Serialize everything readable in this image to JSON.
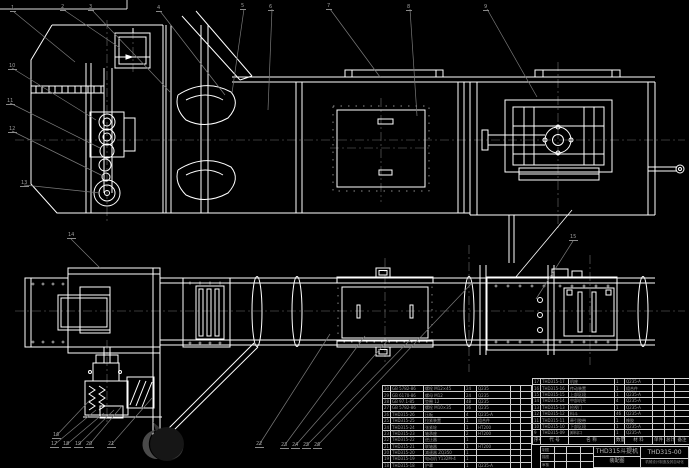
{
  "page": {
    "background": "#000000",
    "line_color": "#ffffff",
    "leader_color": "#7a7a7a",
    "text_color": "#9a9a9a"
  },
  "title_block": {
    "product_name": "THD315斗提机",
    "drawing_type": "装配图",
    "drawing_no": "THD315-00",
    "org": "机械设计制造及其自动化",
    "signoff_rows": [
      [
        "制图",
        "",
        "",
        ""
      ],
      [
        "描图",
        "",
        "",
        ""
      ],
      [
        "审核",
        "",
        "",
        ""
      ]
    ]
  },
  "bom_right": {
    "headers": [
      "序号",
      "代 号",
      "名 称",
      "数量",
      "材 料",
      "单件",
      "总计",
      "备注"
    ],
    "rows": [
      [
        "17",
        "THD315-17",
        "机座",
        "1",
        "Q235-A",
        "",
        "",
        ""
      ],
      [
        "16",
        "THD315-16",
        "传动装置",
        "1",
        "组合件",
        "",
        "",
        ""
      ],
      [
        "15",
        "THD315-15",
        "上部区段",
        "1",
        "Q235-A",
        "",
        "",
        ""
      ],
      [
        "14",
        "THD315-14",
        "中部机壳",
        "4",
        "Q235-A",
        "",
        "",
        ""
      ],
      [
        "13",
        "THD315-13",
        "检视门",
        "1",
        "Q235-A",
        "",
        "",
        ""
      ],
      [
        "12",
        "THD315-12",
        "料斗",
        "46",
        "Q235-A",
        "",
        "",
        ""
      ],
      [
        "11",
        "THD315-11",
        "牵引胶带",
        "1",
        "橡胶",
        "",
        "",
        ""
      ],
      [
        "10",
        "THD315-10",
        "下部区段",
        "1",
        "Q235-A",
        "",
        "",
        ""
      ],
      [
        "9",
        "THD315-09",
        "卸料口",
        "1",
        "Q235-A",
        "",
        "",
        ""
      ]
    ]
  },
  "bom_left": {
    "rows": [
      [
        "30",
        "GB 5782-86",
        "螺栓 M12×45",
        "24",
        "Q235",
        "",
        ""
      ],
      [
        "29",
        "GB 6170-86",
        "螺母 M12",
        "24",
        "Q235",
        "",
        ""
      ],
      [
        "28",
        "GB 97.1-85",
        "垫圈 12",
        "48",
        "Q235",
        "",
        ""
      ],
      [
        "27",
        "GB 5782-86",
        "螺栓 M10×35",
        "36",
        "Q235",
        "",
        ""
      ],
      [
        "26",
        "THD315-26",
        "压板",
        "4",
        "Q235-A",
        "",
        ""
      ],
      [
        "25",
        "THD315-25",
        "拉紧装置",
        "1",
        "组合件",
        "",
        ""
      ],
      [
        "24",
        "THD315-24",
        "张紧轮",
        "1",
        "HT200",
        "",
        ""
      ],
      [
        "23",
        "THD315-23",
        "轴承座",
        "2",
        "HT200",
        "",
        ""
      ],
      [
        "22",
        "THD315-22",
        "逆止器",
        "1",
        "",
        "",
        ""
      ],
      [
        "21",
        "THD315-21",
        "联轴器",
        "1",
        "HT200",
        "",
        ""
      ],
      [
        "20",
        "THD315-20",
        "减速器 ZQ350",
        "1",
        "",
        "",
        ""
      ],
      [
        "19",
        "THD315-19",
        "电动机 Y132M-4",
        "1",
        "",
        "",
        ""
      ],
      [
        "18",
        "THD315-18",
        "护罩",
        "1",
        "Q235-A",
        "",
        ""
      ]
    ]
  },
  "balloons": [
    {
      "n": "1",
      "x": 10,
      "y": 6
    },
    {
      "n": "2",
      "x": 60,
      "y": 5
    },
    {
      "n": "3",
      "x": 88,
      "y": 5
    },
    {
      "n": "4",
      "x": 156,
      "y": 6
    },
    {
      "n": "5",
      "x": 240,
      "y": 4
    },
    {
      "n": "6",
      "x": 268,
      "y": 5
    },
    {
      "n": "7",
      "x": 326,
      "y": 4
    },
    {
      "n": "8",
      "x": 406,
      "y": 5
    },
    {
      "n": "9",
      "x": 483,
      "y": 5
    },
    {
      "n": "10",
      "x": 8,
      "y": 64
    },
    {
      "n": "11",
      "x": 6,
      "y": 99
    },
    {
      "n": "12",
      "x": 8,
      "y": 127
    },
    {
      "n": "13",
      "x": 20,
      "y": 181
    },
    {
      "n": "14",
      "x": 67,
      "y": 233
    },
    {
      "n": "15",
      "x": 569,
      "y": 235
    },
    {
      "n": "16",
      "x": 52,
      "y": 433
    },
    {
      "n": "17",
      "x": 50,
      "y": 442
    },
    {
      "n": "18",
      "x": 62,
      "y": 442
    },
    {
      "n": "19",
      "x": 74,
      "y": 442
    },
    {
      "n": "20",
      "x": 85,
      "y": 442
    },
    {
      "n": "21",
      "x": 107,
      "y": 442
    },
    {
      "n": "22",
      "x": 255,
      "y": 442
    },
    {
      "n": "23",
      "x": 280,
      "y": 443
    },
    {
      "n": "24",
      "x": 291,
      "y": 443
    },
    {
      "n": "25",
      "x": 302,
      "y": 443
    },
    {
      "n": "26",
      "x": 313,
      "y": 443
    }
  ]
}
